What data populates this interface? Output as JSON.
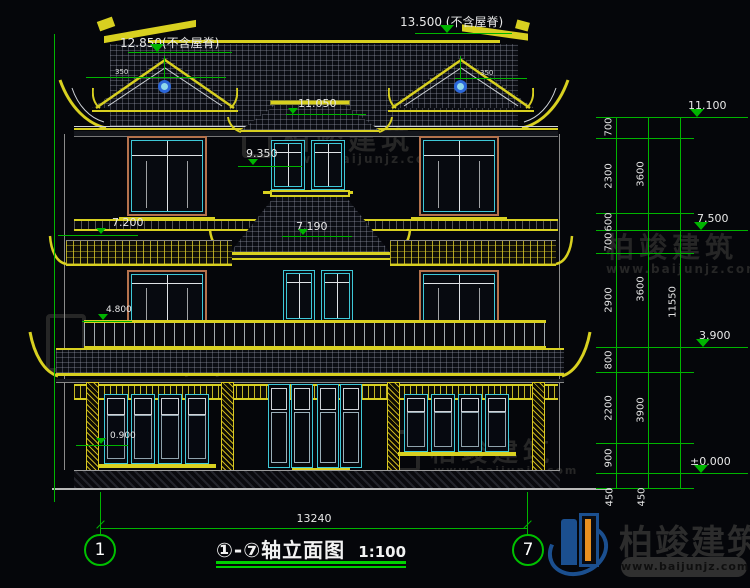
{
  "drawing": {
    "top_annotations": {
      "main_ridge": "13.500 (不含屋脊)",
      "gable_ridge": "12.850(不含屋脊)",
      "eave": "11.050",
      "dormer": "9.350",
      "gable_dim_left": "350",
      "gable_dim_right": "350"
    },
    "mid_annotations": {
      "left_7200": "7.200",
      "center_7190": "7.190",
      "left_4800": "4.800",
      "left_0900": "0.900"
    },
    "right_dimensions": {
      "level_11100": "11.100",
      "level_7500": "7.500",
      "level_3900": "3.900",
      "level_zero": "±0.000",
      "chain_inner": [
        "700",
        "2300",
        "600",
        "700",
        "2900",
        "800",
        "2200",
        "900",
        "450"
      ],
      "chain_mid": [
        "3600",
        "3600",
        "3900",
        "450"
      ],
      "total": "11550"
    },
    "bottom": {
      "overall_width": "13240",
      "axis_left": "1",
      "axis_right": "7",
      "title": "①-⑦轴立面图",
      "scale": "1:100"
    }
  },
  "watermark": {
    "brand": "柏竣建筑",
    "url": "www.baijunjz.com"
  },
  "colors": {
    "background": "#05060a",
    "line_yellow": "#d8d020",
    "line_green": "#00b400",
    "line_cyan": "#3ec8d8",
    "frame_salmon": "#b5724d",
    "text_white": "#e8e8e8"
  }
}
